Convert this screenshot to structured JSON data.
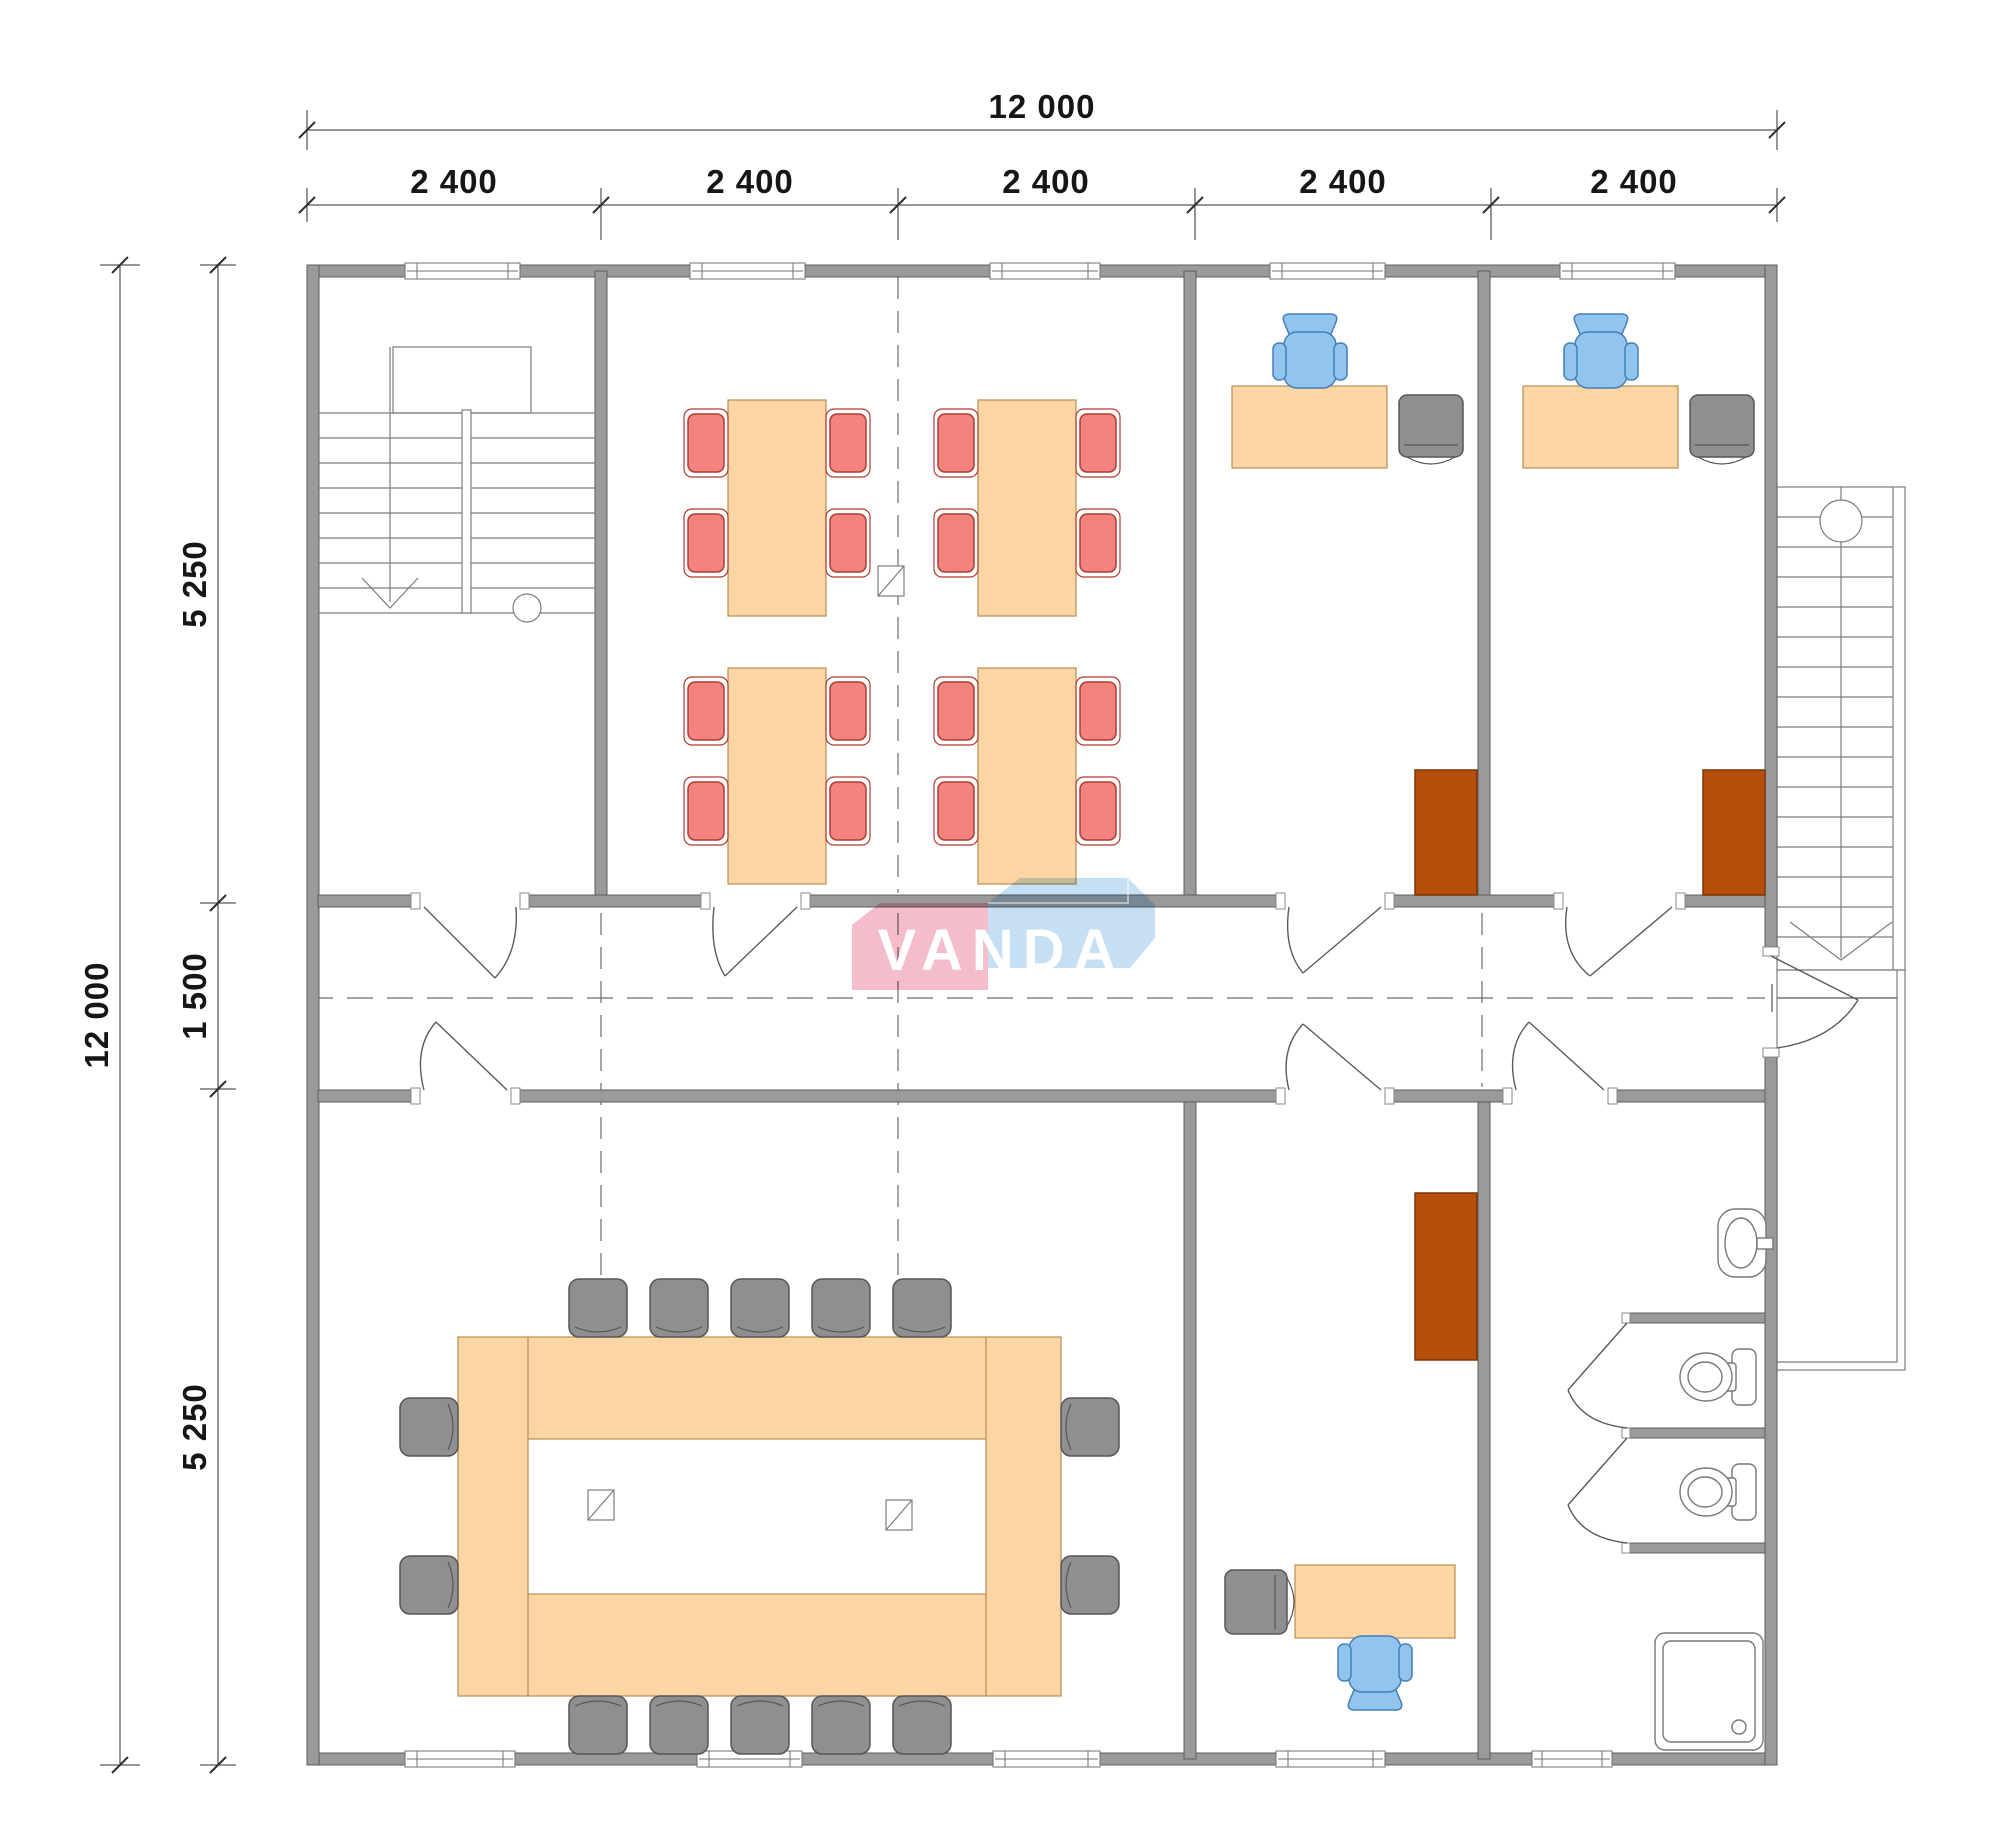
{
  "title": "Office floor plan 12000 x 12000",
  "logo": {
    "text": "VANDA"
  },
  "dimensions": {
    "top": {
      "total": "12 000",
      "segments": [
        "2 400",
        "2 400",
        "2 400",
        "2 400",
        "2 400"
      ]
    },
    "left": {
      "total": "12 000",
      "segments": [
        "5 250",
        "1 500",
        "5 250"
      ]
    }
  },
  "colors": {
    "wall": "#9A9A9A",
    "wallStroke": "#5E5E5E",
    "table": "#FBD6A4",
    "tableStroke": "#B98C52",
    "redChair": "#F2837E",
    "redChairStroke": "#AF3B32",
    "blueChair": "#91C5EE",
    "blueChairStroke": "#447FB8",
    "grayChair": "#8F8F8F",
    "grayChairStroke": "#565656",
    "cabinet": "#B5500C",
    "cabinetStroke": "#7C3505",
    "line": "#7C7C7C",
    "dim": "#2E2E2E",
    "logoPink": "#F5BDC9",
    "logoBlue": "#C5E0F4"
  },
  "rooms": {
    "stairwell": {
      "features": [
        "stairs-down",
        "landing",
        "entry-door"
      ]
    },
    "classroom": {
      "tables": 4,
      "red_chairs": 16,
      "doors": 1,
      "column_markers": 1
    },
    "office_top_1": {
      "desks": 1,
      "blue_chairs": 1,
      "gray_chairs": 1,
      "cabinets": 1
    },
    "office_top_2": {
      "desks": 1,
      "blue_chairs": 1,
      "gray_chairs": 1,
      "cabinets": 1
    },
    "corridor": {
      "width_label": "1 500",
      "doors": 7,
      "exit": "right-exterior-stairs"
    },
    "meeting_room": {
      "conference_table": 1,
      "gray_chairs": 14,
      "column_markers": 2
    },
    "office_bottom": {
      "desks": 1,
      "blue_chairs": 1,
      "gray_chairs": 1,
      "cabinets": 1
    },
    "bathroom": {
      "sinks": 1,
      "toilets": 2,
      "showers": 1,
      "stalls": 2
    },
    "exterior_stairs": {
      "flights": 1,
      "landing": 1
    }
  }
}
